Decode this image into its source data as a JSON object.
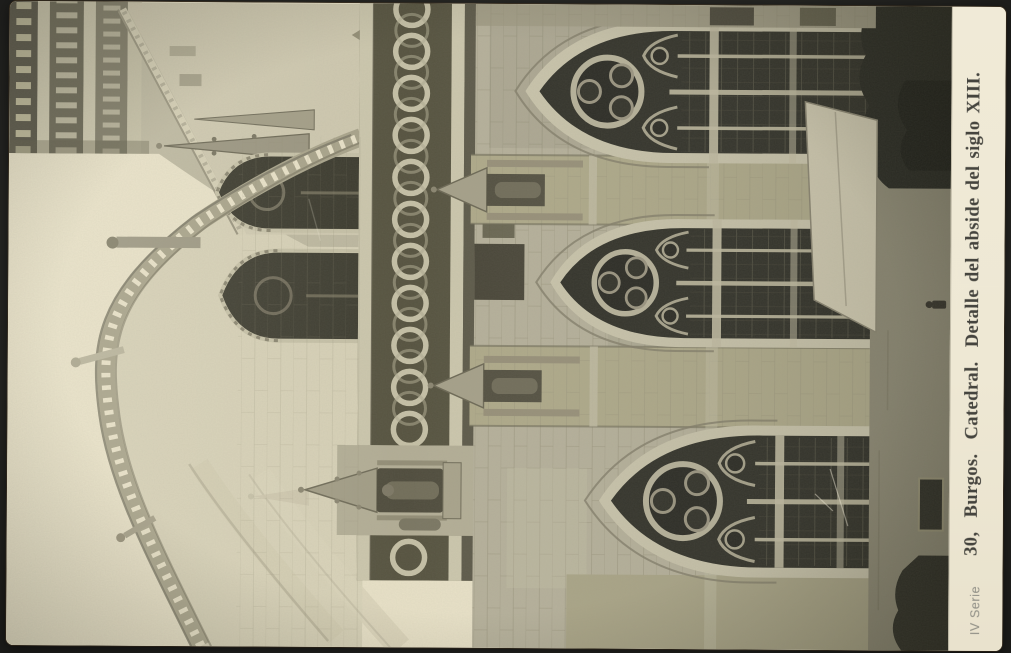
{
  "postcard": {
    "caption": "30,  Burgos.  Catedral.  Detalle del abside del siglo XIII.",
    "series_label": "IV Serie"
  },
  "colors": {
    "backdrop": "#262623",
    "paper": "#eee8d4",
    "caption_ink": "#45443e",
    "series_ink": "#8f8e85",
    "photo_sky": "#e9e2c8",
    "photo_stone_light": "#cdc8af",
    "photo_stone_mid": "#aaa58d",
    "photo_stone_dark": "#6e6a57",
    "photo_glass": "#2e2e26"
  }
}
